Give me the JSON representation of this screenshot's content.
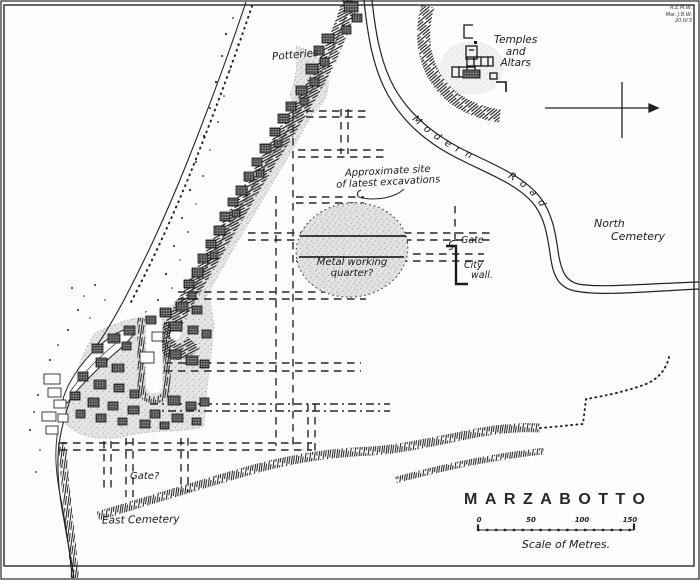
{
  "map": {
    "title": "MARZABOTTO",
    "scale": {
      "caption": "Scale of Metres.",
      "ticks": [
        "0",
        "50",
        "100",
        "150"
      ]
    },
    "signature": {
      "line1": "R.E.M.W.",
      "line2": "Mar. J.B.W.",
      "line3": "20.IV.5"
    },
    "labels": {
      "potteries": "Potteries",
      "temples": {
        "line1": "Temples",
        "line2": "and",
        "line3": "Altars"
      },
      "approx_site": {
        "line1": "Approximate site",
        "line2": "of latest excavations"
      },
      "metal": {
        "line1": "Metal working",
        "line2": "quarter?"
      },
      "gate_north": "Gate",
      "city_wall": {
        "line1": "City",
        "line2": "wall."
      },
      "north_cemetery": {
        "line1": "North",
        "line2": "Cemetery"
      },
      "modern_road": "Modern Road",
      "gate_south": "Gate?",
      "east_cemetery": "East Cemetery"
    },
    "colors": {
      "ink": "#1d1d1d",
      "paper": "#fdfdfc",
      "shade": "#e3e3e3"
    }
  }
}
